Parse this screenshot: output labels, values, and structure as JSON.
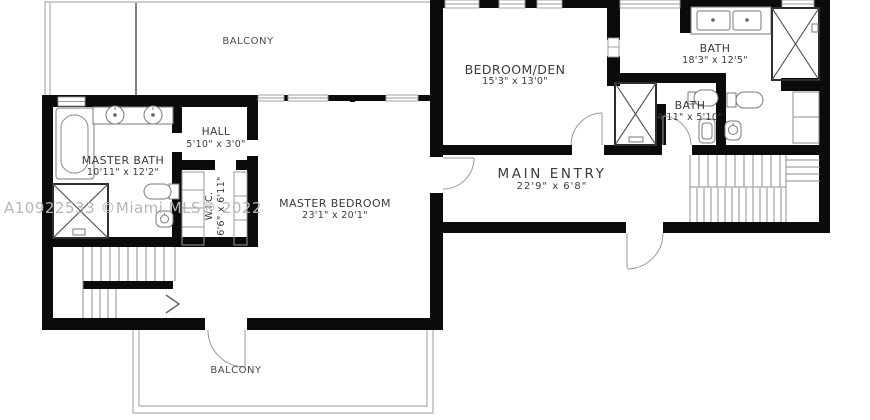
{
  "watermark": {
    "text": "A10922533 ©Miami MLS® 2022"
  },
  "labels": {
    "balcony_top": {
      "name": "BALCONY"
    },
    "master_bath": {
      "name": "MASTER BATH",
      "dims": "10'11\" x 12'2\""
    },
    "hall": {
      "name": "HALL",
      "dims": "5'10\" x 3'0\""
    },
    "wic": {
      "name": "W.I.C.",
      "dims": "6'6\" x 6'11\""
    },
    "master_bedroom": {
      "name": "MASTER BEDROOM",
      "dims": "23'1\" x 20'1\""
    },
    "bedroom_den": {
      "name": "BEDROOM/DEN",
      "dims": "15'3\" x 13'0\""
    },
    "bath_large": {
      "name": "BATH",
      "dims": "18'3\" x 12'5\""
    },
    "bath_small": {
      "name": "BATH",
      "dims": "4'11\" x 5'10\""
    },
    "main_entry": {
      "name": "MAIN ENTRY",
      "dims": "22'9\" x 6'8\""
    },
    "balcony_bottom": {
      "name": "BALCONY"
    }
  },
  "colors": {
    "wall": "#0b0b0b",
    "fixture_line": "#7a7a7a",
    "shower_line": "#2e2e2e",
    "stair_line": "#8c8c8c",
    "balcony_line": "#9b9b9b",
    "text": "#3b3b3b",
    "watermark": "#b6b6b6"
  }
}
